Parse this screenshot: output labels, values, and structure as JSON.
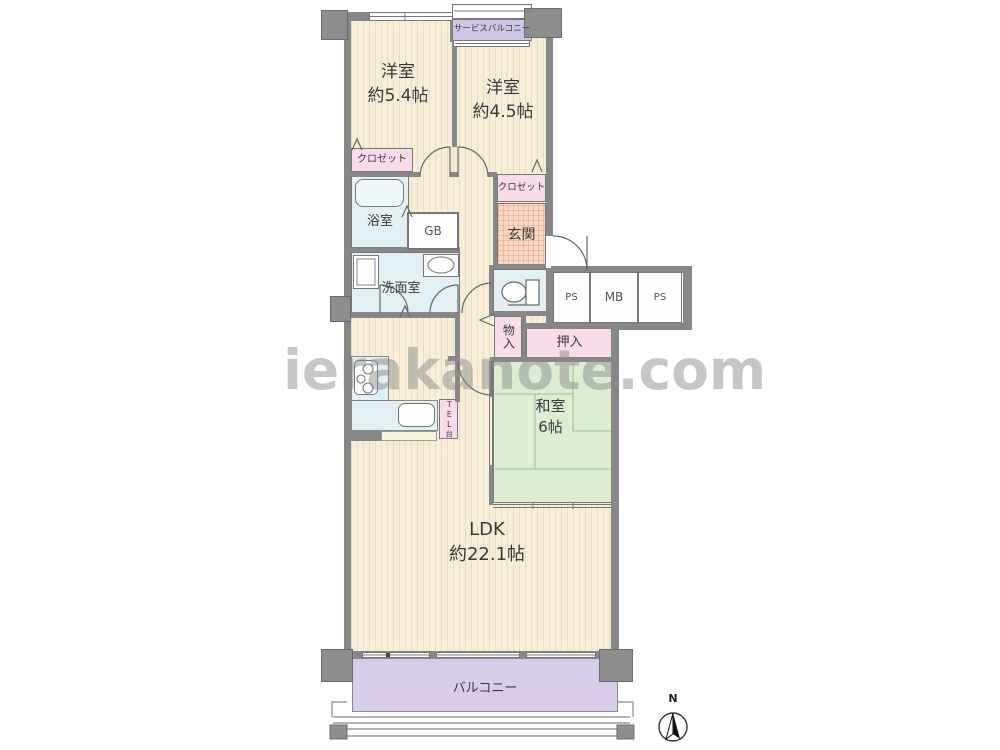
{
  "watermark": "ierakanote.com",
  "compass": {
    "north_label": "N"
  },
  "rooms": {
    "western1": {
      "name": "洋室",
      "size": "約5.4帖"
    },
    "western2": {
      "name": "洋室",
      "size": "約4.5帖"
    },
    "japanese": {
      "name": "和室",
      "size": "6帖"
    },
    "ldk": {
      "name": "LDK",
      "size": "約22.1帖"
    },
    "bath": {
      "name": "浴室"
    },
    "washroom": {
      "name": "洗面室"
    },
    "entrance": {
      "name": "玄関"
    },
    "balcony": {
      "name": "バルコニー"
    },
    "service_balcony": {
      "name": "サービスバルコニー"
    }
  },
  "storage": {
    "closet1": {
      "name": "クロゼット"
    },
    "closet2": {
      "name": "クロゼット"
    },
    "monoire": {
      "name": "物入"
    },
    "oshiire": {
      "name": "押入"
    }
  },
  "utilities": {
    "gb": {
      "name": "GB"
    },
    "tel": {
      "name": "TEL台"
    },
    "ps1": {
      "name": "PS"
    },
    "mb": {
      "name": "MB"
    },
    "ps2": {
      "name": "PS"
    }
  },
  "colors": {
    "wall": "#878787",
    "floor": "#f7eeda",
    "stripe": "#eadec2",
    "water": "#e2f0f3",
    "pink": "#f9dcea",
    "tatami": "#dcedd4",
    "balcony": "#d7cde8",
    "genkan": "#f8d8c2",
    "watermark": "#8a8a8a"
  }
}
